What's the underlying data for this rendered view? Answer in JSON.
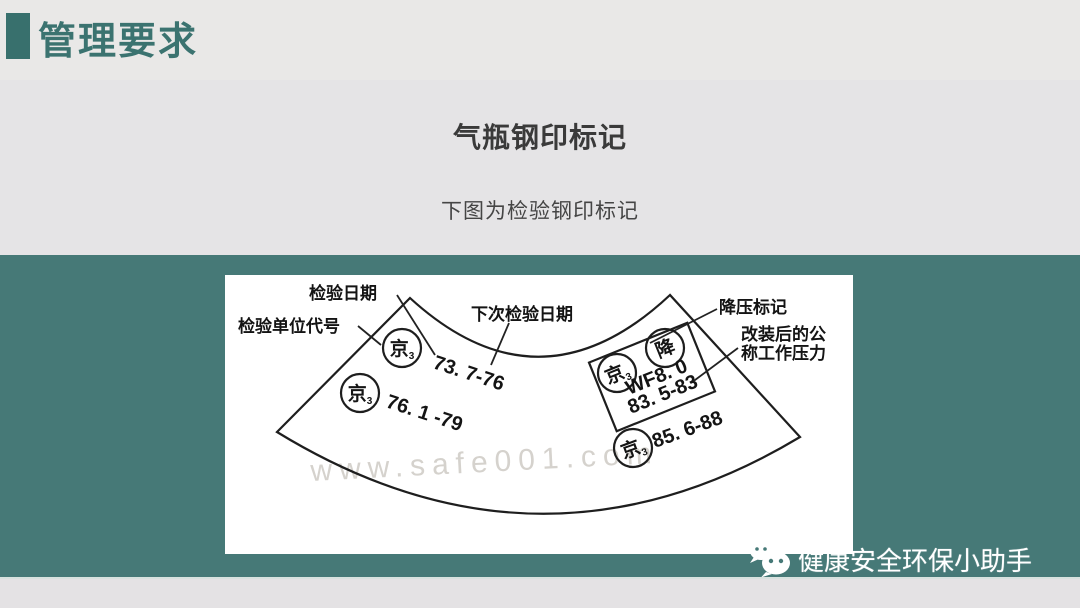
{
  "header": {
    "title": "管理要求"
  },
  "content": {
    "title": "气瓶钢印标记",
    "subtitle": "下图为检验钢印标记"
  },
  "diagram": {
    "labels": {
      "inspection_date": "检验日期",
      "inspection_unit_code": "检验单位代号",
      "next_inspection_date": "下次检验日期",
      "pressure_reduction_mark": "降压标记",
      "modified_pressure_line1": "改装后的公",
      "modified_pressure_line2": "称工作压力"
    },
    "stamps": {
      "unit_code": "京",
      "unit_code_sub": "3",
      "reduction_mark": "降",
      "date_1": "73. 7-76",
      "date_2": "76. 1 -79",
      "pressure_value": "WF8. 0",
      "date_3": "83. 5-83",
      "date_4": "85. 6-88"
    },
    "watermark": "www.safe001.com"
  },
  "footer": {
    "watermark_text": "健康安全环保小助手"
  },
  "colors": {
    "band_teal": "#467977",
    "title_teal": "#3b7370",
    "accent_bar": "#38706d",
    "background": "#e5e4e6"
  }
}
